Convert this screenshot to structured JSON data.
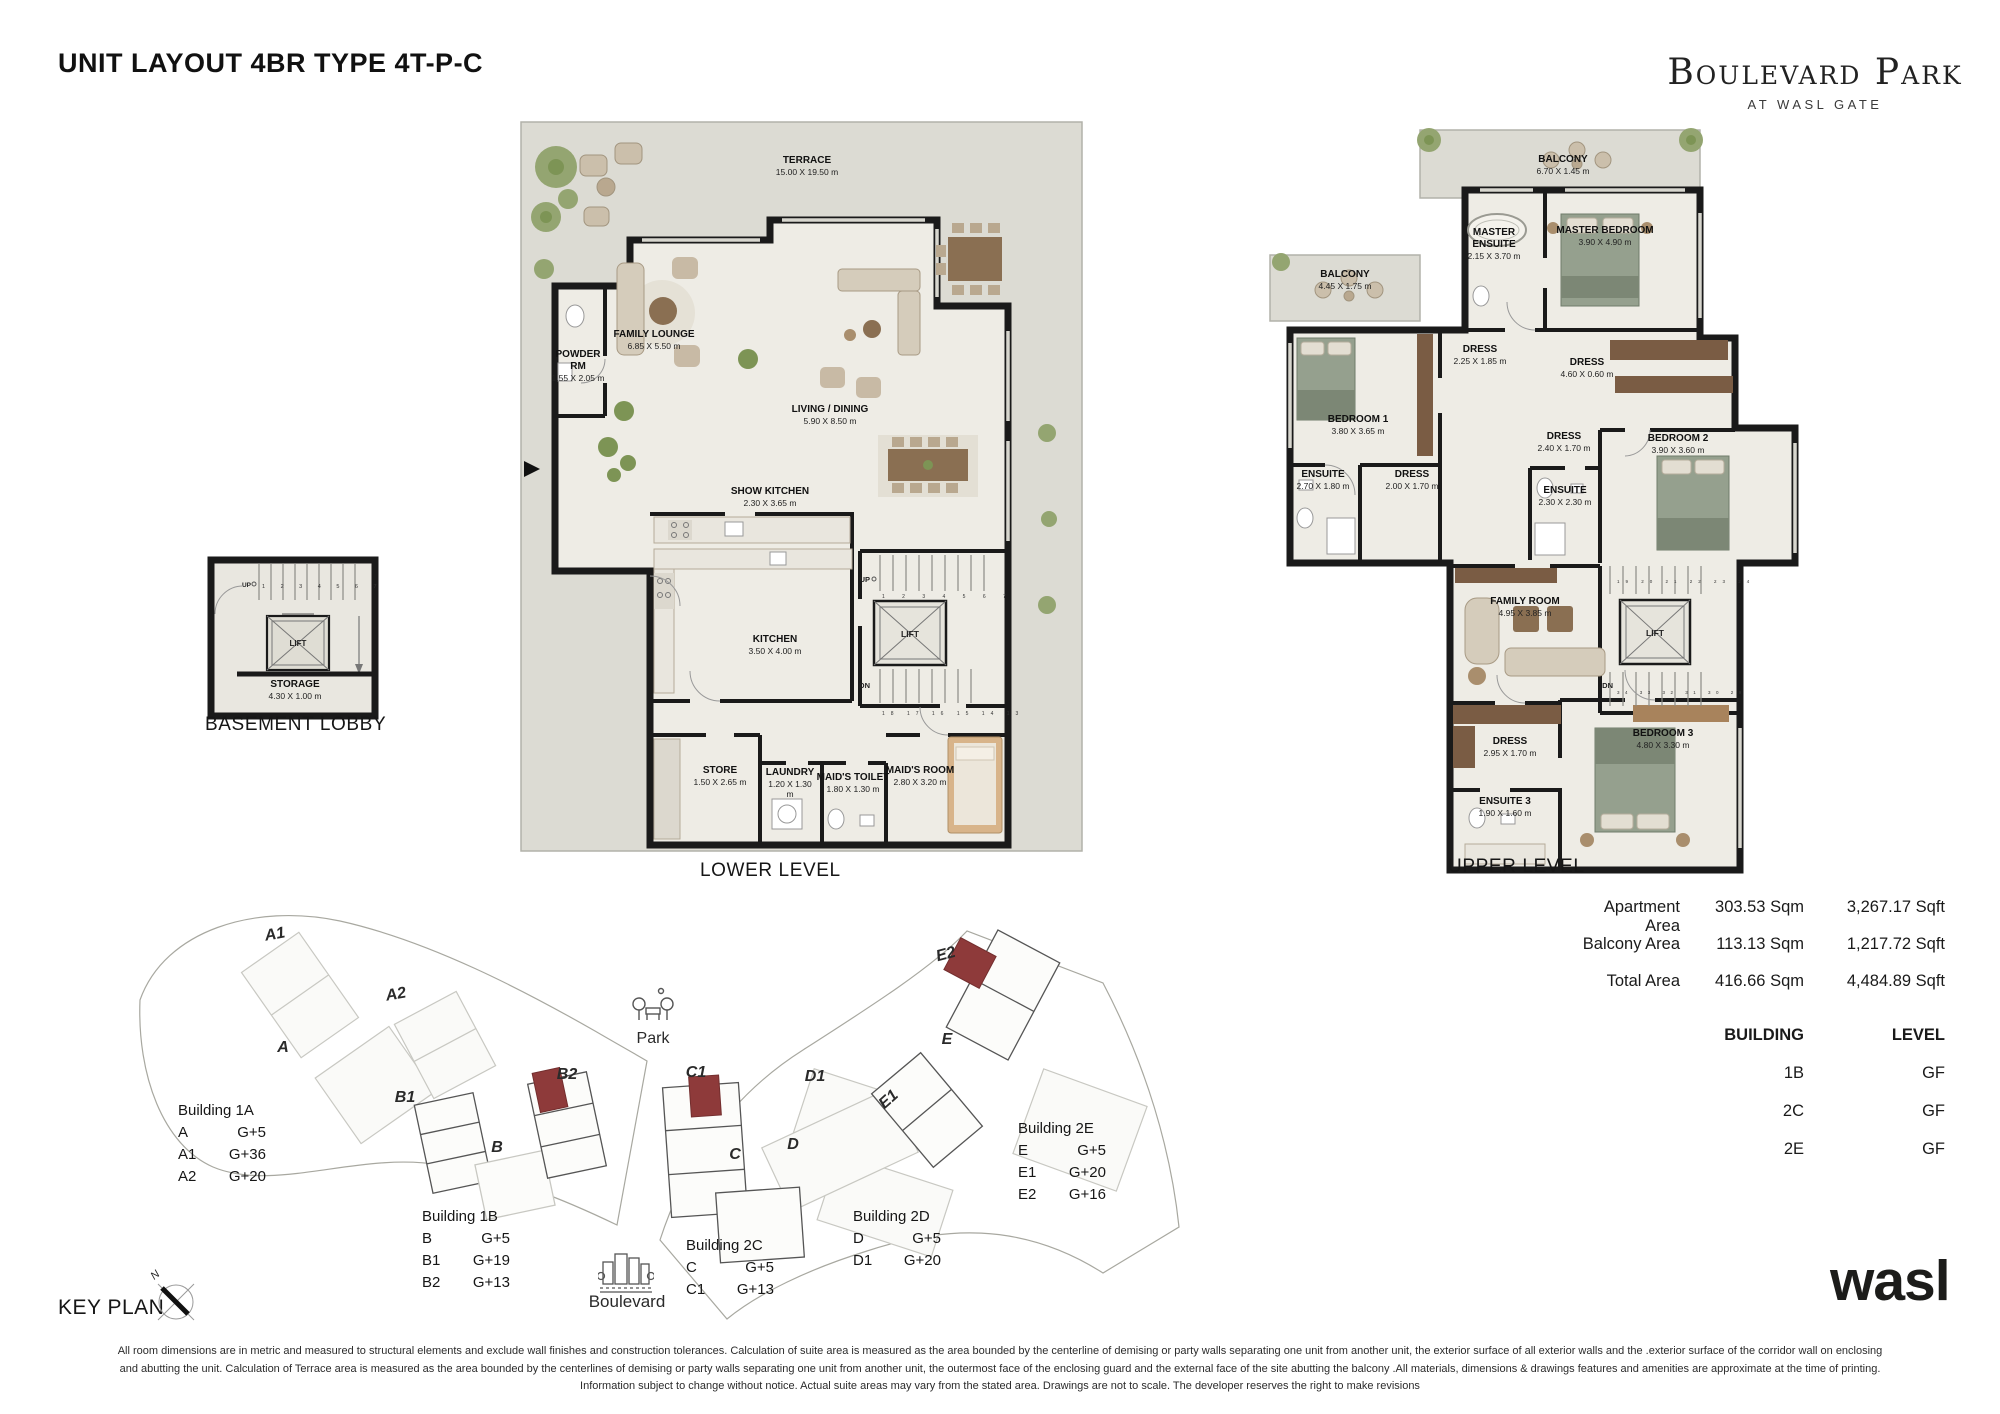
{
  "header": {
    "title": "UNIT LAYOUT 4BR TYPE 4T-P-C",
    "brand_name": "Boulevard Park",
    "brand_subtitle": "AT WASL GATE"
  },
  "lower": {
    "caption": "LOWER LEVEL",
    "terrace": {
      "name": "TERRACE",
      "dims": "15.00 X 19.50 m"
    },
    "powder": {
      "name": "POWDER RM",
      "dims": "1.55 X 2.05 m"
    },
    "family_lounge": {
      "name": "FAMILY LOUNGE",
      "dims": "6.85 X 5.50 m"
    },
    "living": {
      "name": "LIVING / DINING",
      "dims": "5.90 X 8.50 m"
    },
    "show_kitchen": {
      "name": "SHOW KITCHEN",
      "dims": "2.30 X 3.65 m"
    },
    "kitchen": {
      "name": "KITCHEN",
      "dims": "3.50 X 4.00 m"
    },
    "store": {
      "name": "STORE",
      "dims": "1.50 X 2.65 m"
    },
    "laundry": {
      "name": "LAUNDRY",
      "dims": "1.20 X 1.30 m"
    },
    "maids_toilet": {
      "name": "MAID'S TOILET",
      "dims": "1.80 X 1.30 m"
    },
    "maids_room": {
      "name": "MAID'S ROOM",
      "dims": "2.80 X 3.20 m"
    },
    "lift": "LIFT",
    "up": "UP",
    "dn": "DN",
    "stairs_up_nums": "1 2 3 4 5 6 7",
    "stairs_dn_nums": "18 17 16 15 14 13"
  },
  "basement": {
    "caption": "BASEMENT LOBBY",
    "lift": "LIFT",
    "up": "UP",
    "stair_nums": "1 2 3 4 5 6 7 8",
    "storage": {
      "name": "STORAGE",
      "dims": "4.30 X 1.00 m"
    }
  },
  "upper": {
    "caption": "UPPER LEVEL",
    "balcony_top": {
      "name": "BALCONY",
      "dims": "6.70 X 1.45 m"
    },
    "balcony_left": {
      "name": "BALCONY",
      "dims": "4.45 X 1.75 m"
    },
    "master_ensuite": {
      "name": "MASTER ENSUITE",
      "dims": "2.15 X 3.70 m"
    },
    "master_bedroom": {
      "name": "MASTER BEDROOM",
      "dims": "3.90 X 4.90 m"
    },
    "bedroom1": {
      "name": "BEDROOM 1",
      "dims": "3.80 X 3.65 m"
    },
    "dress_a": {
      "name": "DRESS",
      "dims": "2.25 X 1.85 m"
    },
    "dress_b": {
      "name": "DRESS",
      "dims": "4.60 X 0.60 m"
    },
    "dress_c": {
      "name": "DRESS",
      "dims": "2.40 X 1.70 m"
    },
    "bedroom2": {
      "name": "BEDROOM 2",
      "dims": "3.90 X 3.60 m"
    },
    "ensuite1": {
      "name": "ENSUITE",
      "dims": "2.70 X 1.80 m"
    },
    "dress_d": {
      "name": "DRESS",
      "dims": "2.00 X 1.70 m"
    },
    "ensuite2": {
      "name": "ENSUITE",
      "dims": "2.30 X 2.30 m"
    },
    "family_room": {
      "name": "FAMILY ROOM",
      "dims": "4.95 X 3.85 m"
    },
    "dress_e": {
      "name": "DRESS",
      "dims": "2.95 X 1.70 m"
    },
    "bedroom3": {
      "name": "BEDROOM 3",
      "dims": "4.80 X 3.30 m"
    },
    "ensuite3": {
      "name": "ENSUITE 3",
      "dims": "1.90 X 1.60 m"
    },
    "lift": "LIFT",
    "dn": "DN",
    "stairs_top_nums": "19 20 21 22 23 24",
    "stairs_bottom_nums": "34 33 32 31 30 29"
  },
  "areas": {
    "rows": [
      {
        "label": "Apartment Area",
        "sqm": "303.53 Sqm",
        "sqft": "3,267.17 Sqft"
      },
      {
        "label": "Balcony Area",
        "sqm": "113.13 Sqm",
        "sqft": "1,217.72 Sqft"
      },
      {
        "label": "Total Area",
        "sqm": "416.66 Sqm",
        "sqft": "4,484.89 Sqft"
      }
    ]
  },
  "building_table": {
    "col1": "BUILDING",
    "col2": "LEVEL",
    "rows": [
      {
        "b": "1B",
        "l": "GF"
      },
      {
        "b": "2C",
        "l": "GF"
      },
      {
        "b": "2E",
        "l": "GF"
      }
    ]
  },
  "keyplan": {
    "caption": "KEY PLAN",
    "north": "N",
    "park": "Park",
    "boulevard": "Boulevard",
    "map": {
      "a1": "A1",
      "a2": "A2",
      "a": "A",
      "b1": "B1",
      "b2": "B2",
      "b": "B",
      "c1": "C1",
      "c": "C",
      "d1": "D1",
      "d": "D",
      "e1": "E1",
      "e": "E",
      "e2": "E2"
    },
    "legends": [
      {
        "title": "Building 1A",
        "rows": [
          {
            "c": "A",
            "v": "G+5"
          },
          {
            "c": "A1",
            "v": "G+36"
          },
          {
            "c": "A2",
            "v": "G+20"
          }
        ]
      },
      {
        "title": "Building 1B",
        "rows": [
          {
            "c": "B",
            "v": "G+5"
          },
          {
            "c": "B1",
            "v": "G+19"
          },
          {
            "c": "B2",
            "v": "G+13"
          }
        ]
      },
      {
        "title": "Building 2C",
        "rows": [
          {
            "c": "C",
            "v": "G+5"
          },
          {
            "c": "C1",
            "v": "G+13"
          }
        ]
      },
      {
        "title": "Building 2D",
        "rows": [
          {
            "c": "D",
            "v": "G+5"
          },
          {
            "c": "D1",
            "v": "G+20"
          }
        ]
      },
      {
        "title": "Building 2E",
        "rows": [
          {
            "c": "E",
            "v": "G+5"
          },
          {
            "c": "E1",
            "v": "G+20"
          },
          {
            "c": "E2",
            "v": "G+16"
          }
        ]
      }
    ],
    "highlight_color": "#8e3a3a"
  },
  "footer": {
    "wasl": "wasl",
    "disclaimer1": "All room dimensions are in metric and measured to structural elements and exclude wall finishes and construction tolerances. Calculation of suite area is measured as the area bounded by the centerline of demising or party walls separating one unit from another unit, the exterior surface of all exterior walls and the .exterior surface of the corridor wall on enclosing",
    "disclaimer2": "and abutting the unit. Calculation of Terrace area is measured as the area bounded by the centerlines of demising or party walls separating one unit from another unit, the outermost face of the enclosing guard and the external face of the site abutting the balcony .All materials, dimensions & drawings features and amenities are approximate at the time of printing.",
    "disclaimer3": "Information subject to change without notice. Actual suite areas may vary from the stated area. Drawings are not to scale. The developer reserves the right to make revisions"
  }
}
